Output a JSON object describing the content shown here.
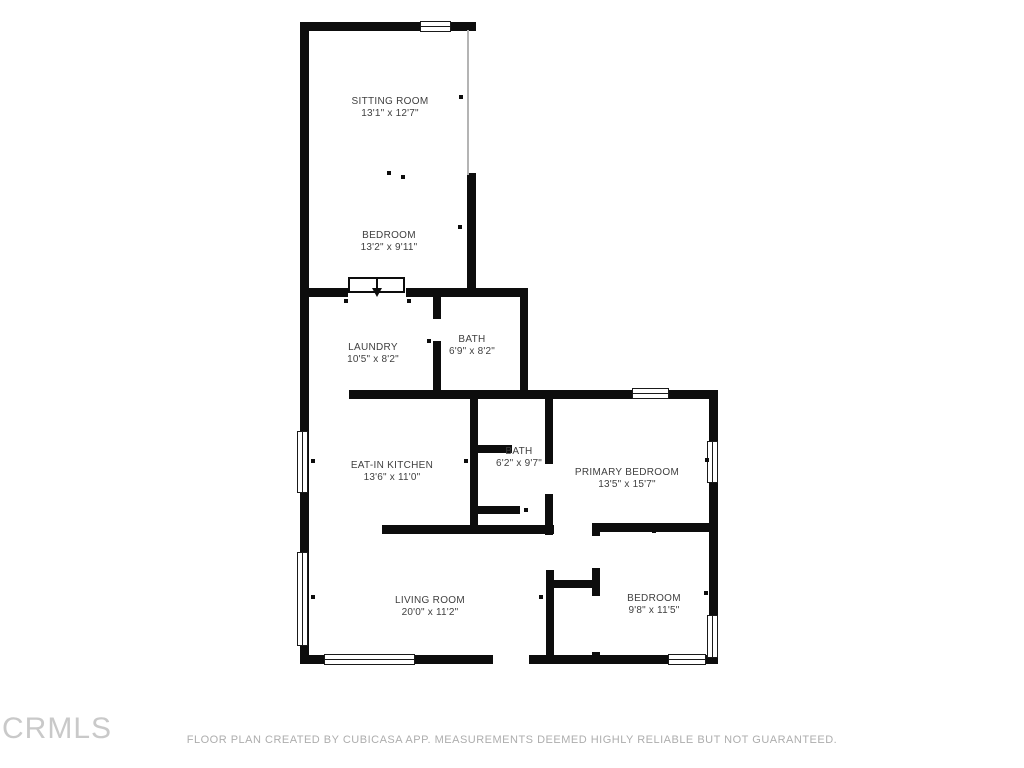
{
  "plan": {
    "rooms": [
      {
        "name": "SITTING ROOM",
        "dims": "13'1\" x 12'7\""
      },
      {
        "name": "BEDROOM",
        "dims": "13'2\" x 9'11\""
      },
      {
        "name": "LAUNDRY",
        "dims": "10'5\" x 8'2\""
      },
      {
        "name": "BATH",
        "dims": "6'9\" x 8'2\""
      },
      {
        "name": "EAT-IN KITCHEN",
        "dims": "13'6\" x 11'0\""
      },
      {
        "name": "BATH",
        "dims": "6'2\" x 9'7\""
      },
      {
        "name": "PRIMARY BEDROOM",
        "dims": "13'5\" x 15'7\""
      },
      {
        "name": "LIVING ROOM",
        "dims": "20'0\" x 11'2\""
      },
      {
        "name": "BEDROOM",
        "dims": "9'8\" x 11'5\""
      }
    ]
  },
  "footer": {
    "logo": "CRMLS",
    "disclaimer": "FLOOR PLAN CREATED BY CUBICASA APP. MEASUREMENTS DEEMED HIGHLY RELIABLE BUT NOT GUARANTEED."
  },
  "colors": {
    "wall": "#0d0d0d",
    "label_text": "#3f3f3f",
    "footer_text": "#adadad",
    "logo_text": "#c9c9c9",
    "background": "#ffffff"
  }
}
